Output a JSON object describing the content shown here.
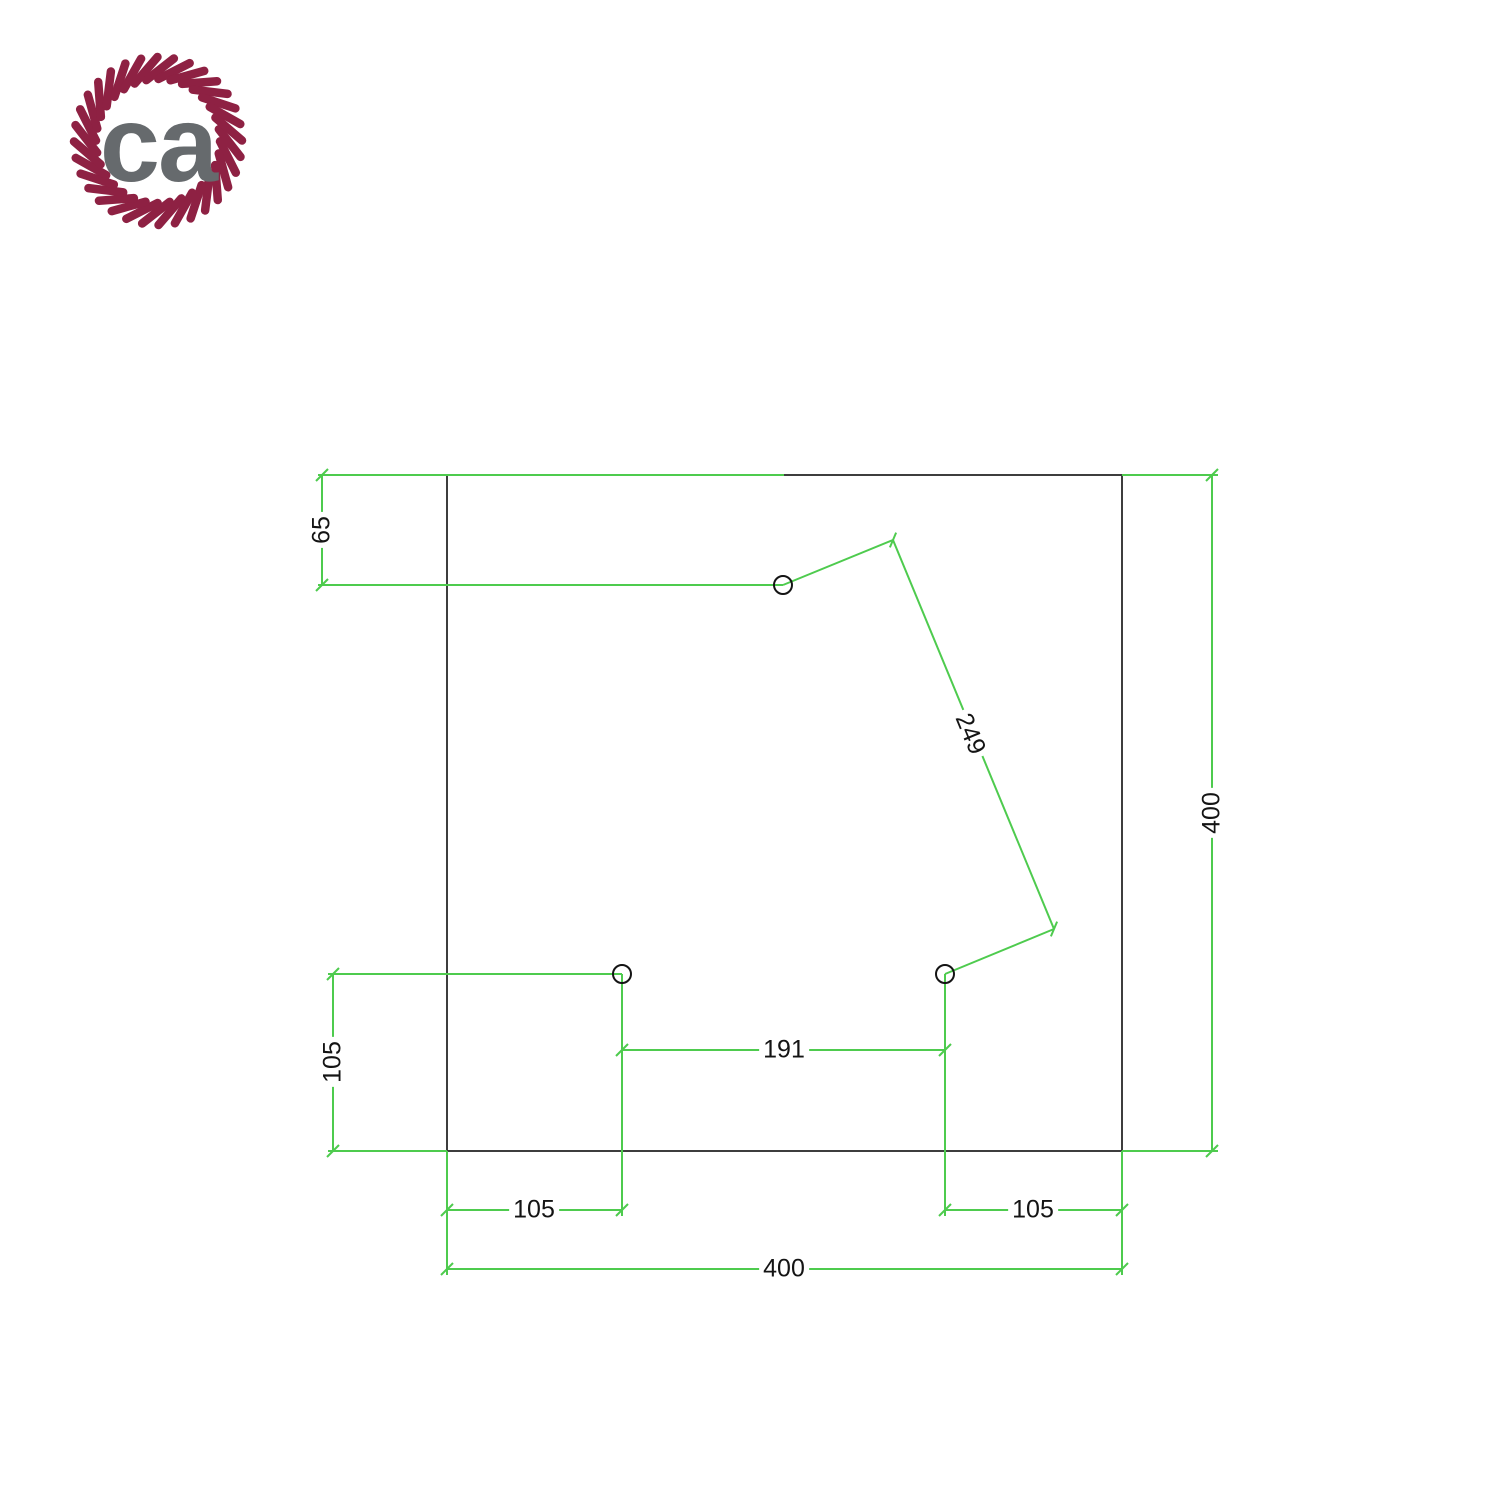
{
  "logo": {
    "text": "ca",
    "rope_color": "#8e2143",
    "text_color": "#666a6d"
  },
  "drawing": {
    "colors": {
      "dimension": "#4ecb4e",
      "outline": "#3d3d3d",
      "hole": "#141414",
      "text": "#141414"
    },
    "labels": {
      "dim_65": "65",
      "dim_105_left": "105",
      "dim_191": "191",
      "dim_249": "249",
      "dim_105_bottom_left": "105",
      "dim_105_bottom_right": "105",
      "dim_400_bottom": "400",
      "dim_400_right": "400"
    }
  }
}
